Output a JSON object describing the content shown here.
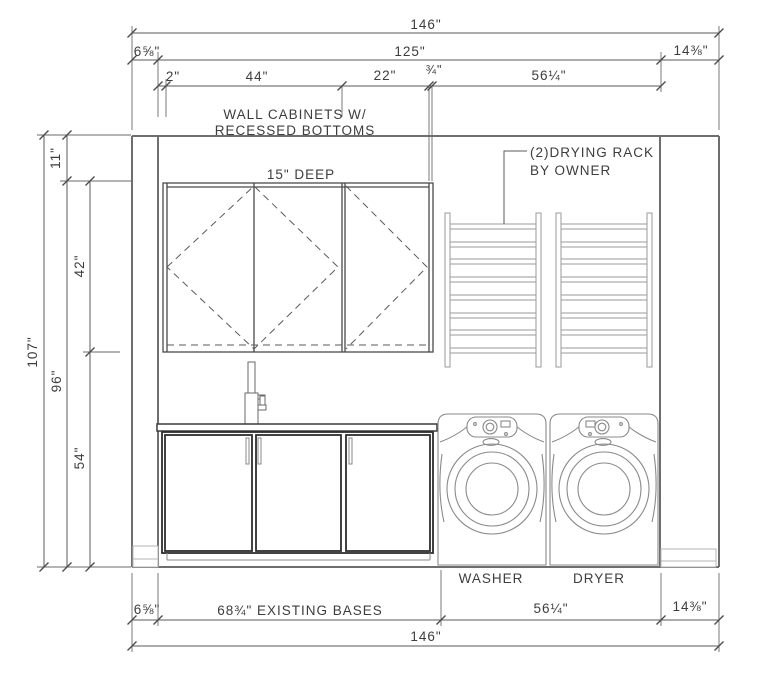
{
  "drawing": {
    "notes": {
      "wall_cabinets_line1": "WALL CABINETS W/",
      "wall_cabinets_line2": "RECESSED BOTTOMS",
      "cabinet_depth": "15\" DEEP",
      "drying_rack_line1": "(2)DRYING RACK",
      "drying_rack_line2": "BY OWNER"
    },
    "appliances": {
      "washer": "WASHER",
      "dryer": "DRYER"
    },
    "dim_top": {
      "overall": "146\"",
      "left_wall": "6⅝\"",
      "interior": "125\"",
      "right_wall": "14⅜\"",
      "filler": "2\"",
      "wall_cab_double": "44\"",
      "wall_cab_single": "22\"",
      "spacer": "¾\"",
      "appliance_space": "56¼\""
    },
    "dim_left": {
      "overall": "107\"",
      "floor_to_ceiling": "96\"",
      "above_cabinets": "11\"",
      "cabinet_height": "42\"",
      "below_cabinets": "54\""
    },
    "dim_bottom": {
      "left_wall": "6⅝\"",
      "existing_bases": "68¾\" EXISTING BASES",
      "appliance_space": "56¼\"",
      "right_wall": "14⅜\"",
      "overall": "146\""
    }
  },
  "colors": {
    "line": "#4a4a4a",
    "line_light": "#9a9a9a",
    "background": "#ffffff"
  }
}
